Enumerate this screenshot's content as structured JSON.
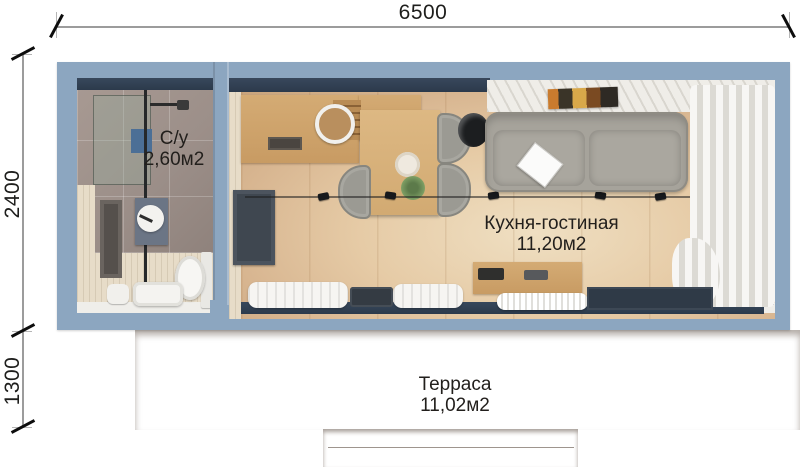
{
  "plan": {
    "dimensions": {
      "total_width_mm": "6500",
      "main_depth_mm": "2400",
      "terrace_depth_mm": "1300"
    },
    "rooms": {
      "bathroom": {
        "name": "С/у",
        "area": "2,60м2",
        "furniture": [
          "shower-glass",
          "shower-head",
          "bath-mat",
          "wall-niche",
          "vanity",
          "round-mirror",
          "toilet",
          "stool"
        ]
      },
      "kitchen_living": {
        "name": "Кухня-гостиная",
        "area": "11,20м2",
        "furniture": [
          "kitchen-counter",
          "round-sink",
          "cooktop",
          "dining-table",
          "chairs",
          "floor-lamp",
          "sofa",
          "laptop",
          "wall-art",
          "tv-panel",
          "track-lights",
          "media-console",
          "ac-unit",
          "curtains",
          "window-bench"
        ]
      },
      "terrace": {
        "name": "Терраса",
        "area": "11,02м2",
        "furniture": [
          "deck-planks",
          "entry-step"
        ]
      }
    }
  },
  "colors": {
    "wall": "#8ca6c0",
    "wall_dark": "#2c3a4b",
    "bath_tile": "#9c8f89",
    "bath_floor": "#e7dcc8",
    "floor_wood": "#d8b691",
    "floor_light": "#efdfc2",
    "kitchen_wood": "#c89b63",
    "table_wood": "#d2aa72",
    "sofa": "#a6a39b",
    "curtain": "#f4f3f1",
    "terrace_wood": "#a06a40",
    "terrace_gap": "#5c3520",
    "sill": "#efeeea",
    "dim_line": "#9c9c9c",
    "text": "#1e1e1c"
  }
}
